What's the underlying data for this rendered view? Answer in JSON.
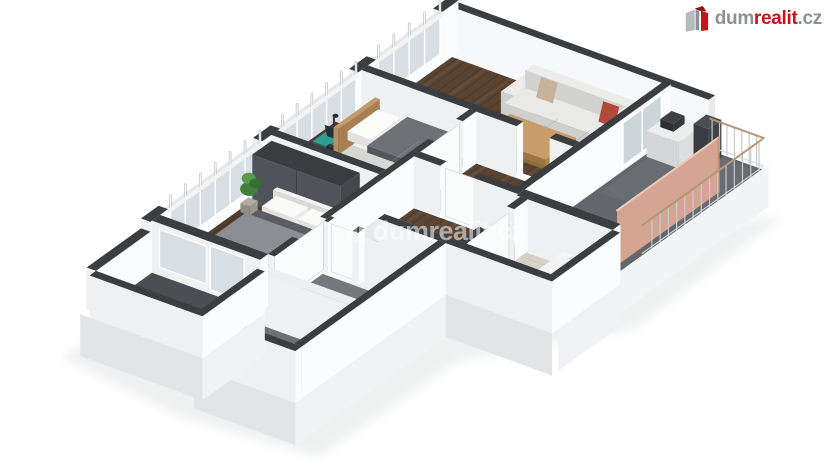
{
  "image": {
    "type": "3d-floor-plan-render",
    "background": "#ffffff"
  },
  "logo": {
    "part_dum": "dum",
    "part_realit": "realit",
    "part_cz": ".cz"
  },
  "watermark": {
    "text": "dumrealit.cz"
  },
  "colors": {
    "logo_gray": "#8e9194",
    "logo_red": "#c2161d",
    "logo_dark_red": "#8e1014",
    "logo_light_gray": "#b7babd",
    "watermark_white": "#ffffff",
    "wall_cap": "#3b3e41",
    "wall_cap_light": "#e8eaec",
    "wall_face_se": "#fbfcfd",
    "wall_face_sw": "#eef0f2",
    "skirt_se": "#f1f2f4",
    "skirt_sw": "#e2e4e6",
    "wood_living": "#5a4331",
    "wood_study": "#56402f",
    "wood_bedroom": "#533d2d",
    "wood_hall": "#5b4433",
    "terrace_floor": "#63676b",
    "bath_floor": "#d8d2c7",
    "storage_floor_1": "#74787c",
    "storage_floor_2": "#6d7175",
    "balcony_floor": "#4b4f53",
    "glass": "#d7dfe4",
    "rail_post": "#c7cbce",
    "rail_top": "#b59878",
    "partition_salmon": "#d6a492",
    "partition_edge": "#ecc9b8",
    "sofa_white": "#e9e9e7",
    "pillow_tan": "#c9b29a",
    "pillow_red": "#b24a3c",
    "table_oak": "#c79e6b",
    "desk_wood": "#4f3a2b",
    "laptop_teal": "#2f9e92",
    "chair_black": "#2c2f32",
    "bed_frame": "#f1f1ef",
    "headboard_oak": "#c39a6c",
    "blanket_gray": "#6e7276",
    "duvet_gray": "#8b8f93",
    "wardrobe_gray": "#50545a",
    "plant_green": "#41803b",
    "fixture_white": "#f7f8f7",
    "shadow": "#e2e4e5"
  },
  "scene": {
    "rooms": [
      "living-room",
      "study-bedroom",
      "master-bedroom",
      "hallway",
      "corridor",
      "bathroom",
      "storage-room-1",
      "storage-room-2",
      "terrace",
      "balcony"
    ],
    "furniture": [
      "sofa",
      "coffee-table",
      "potted-plant",
      "desk",
      "office-chair",
      "laptop",
      "single-bed",
      "wardrobe",
      "double-bed",
      "toilet",
      "bathtub",
      "washbasin",
      "terrace-cabinet",
      "balcony-railing",
      "privacy-partition"
    ]
  }
}
